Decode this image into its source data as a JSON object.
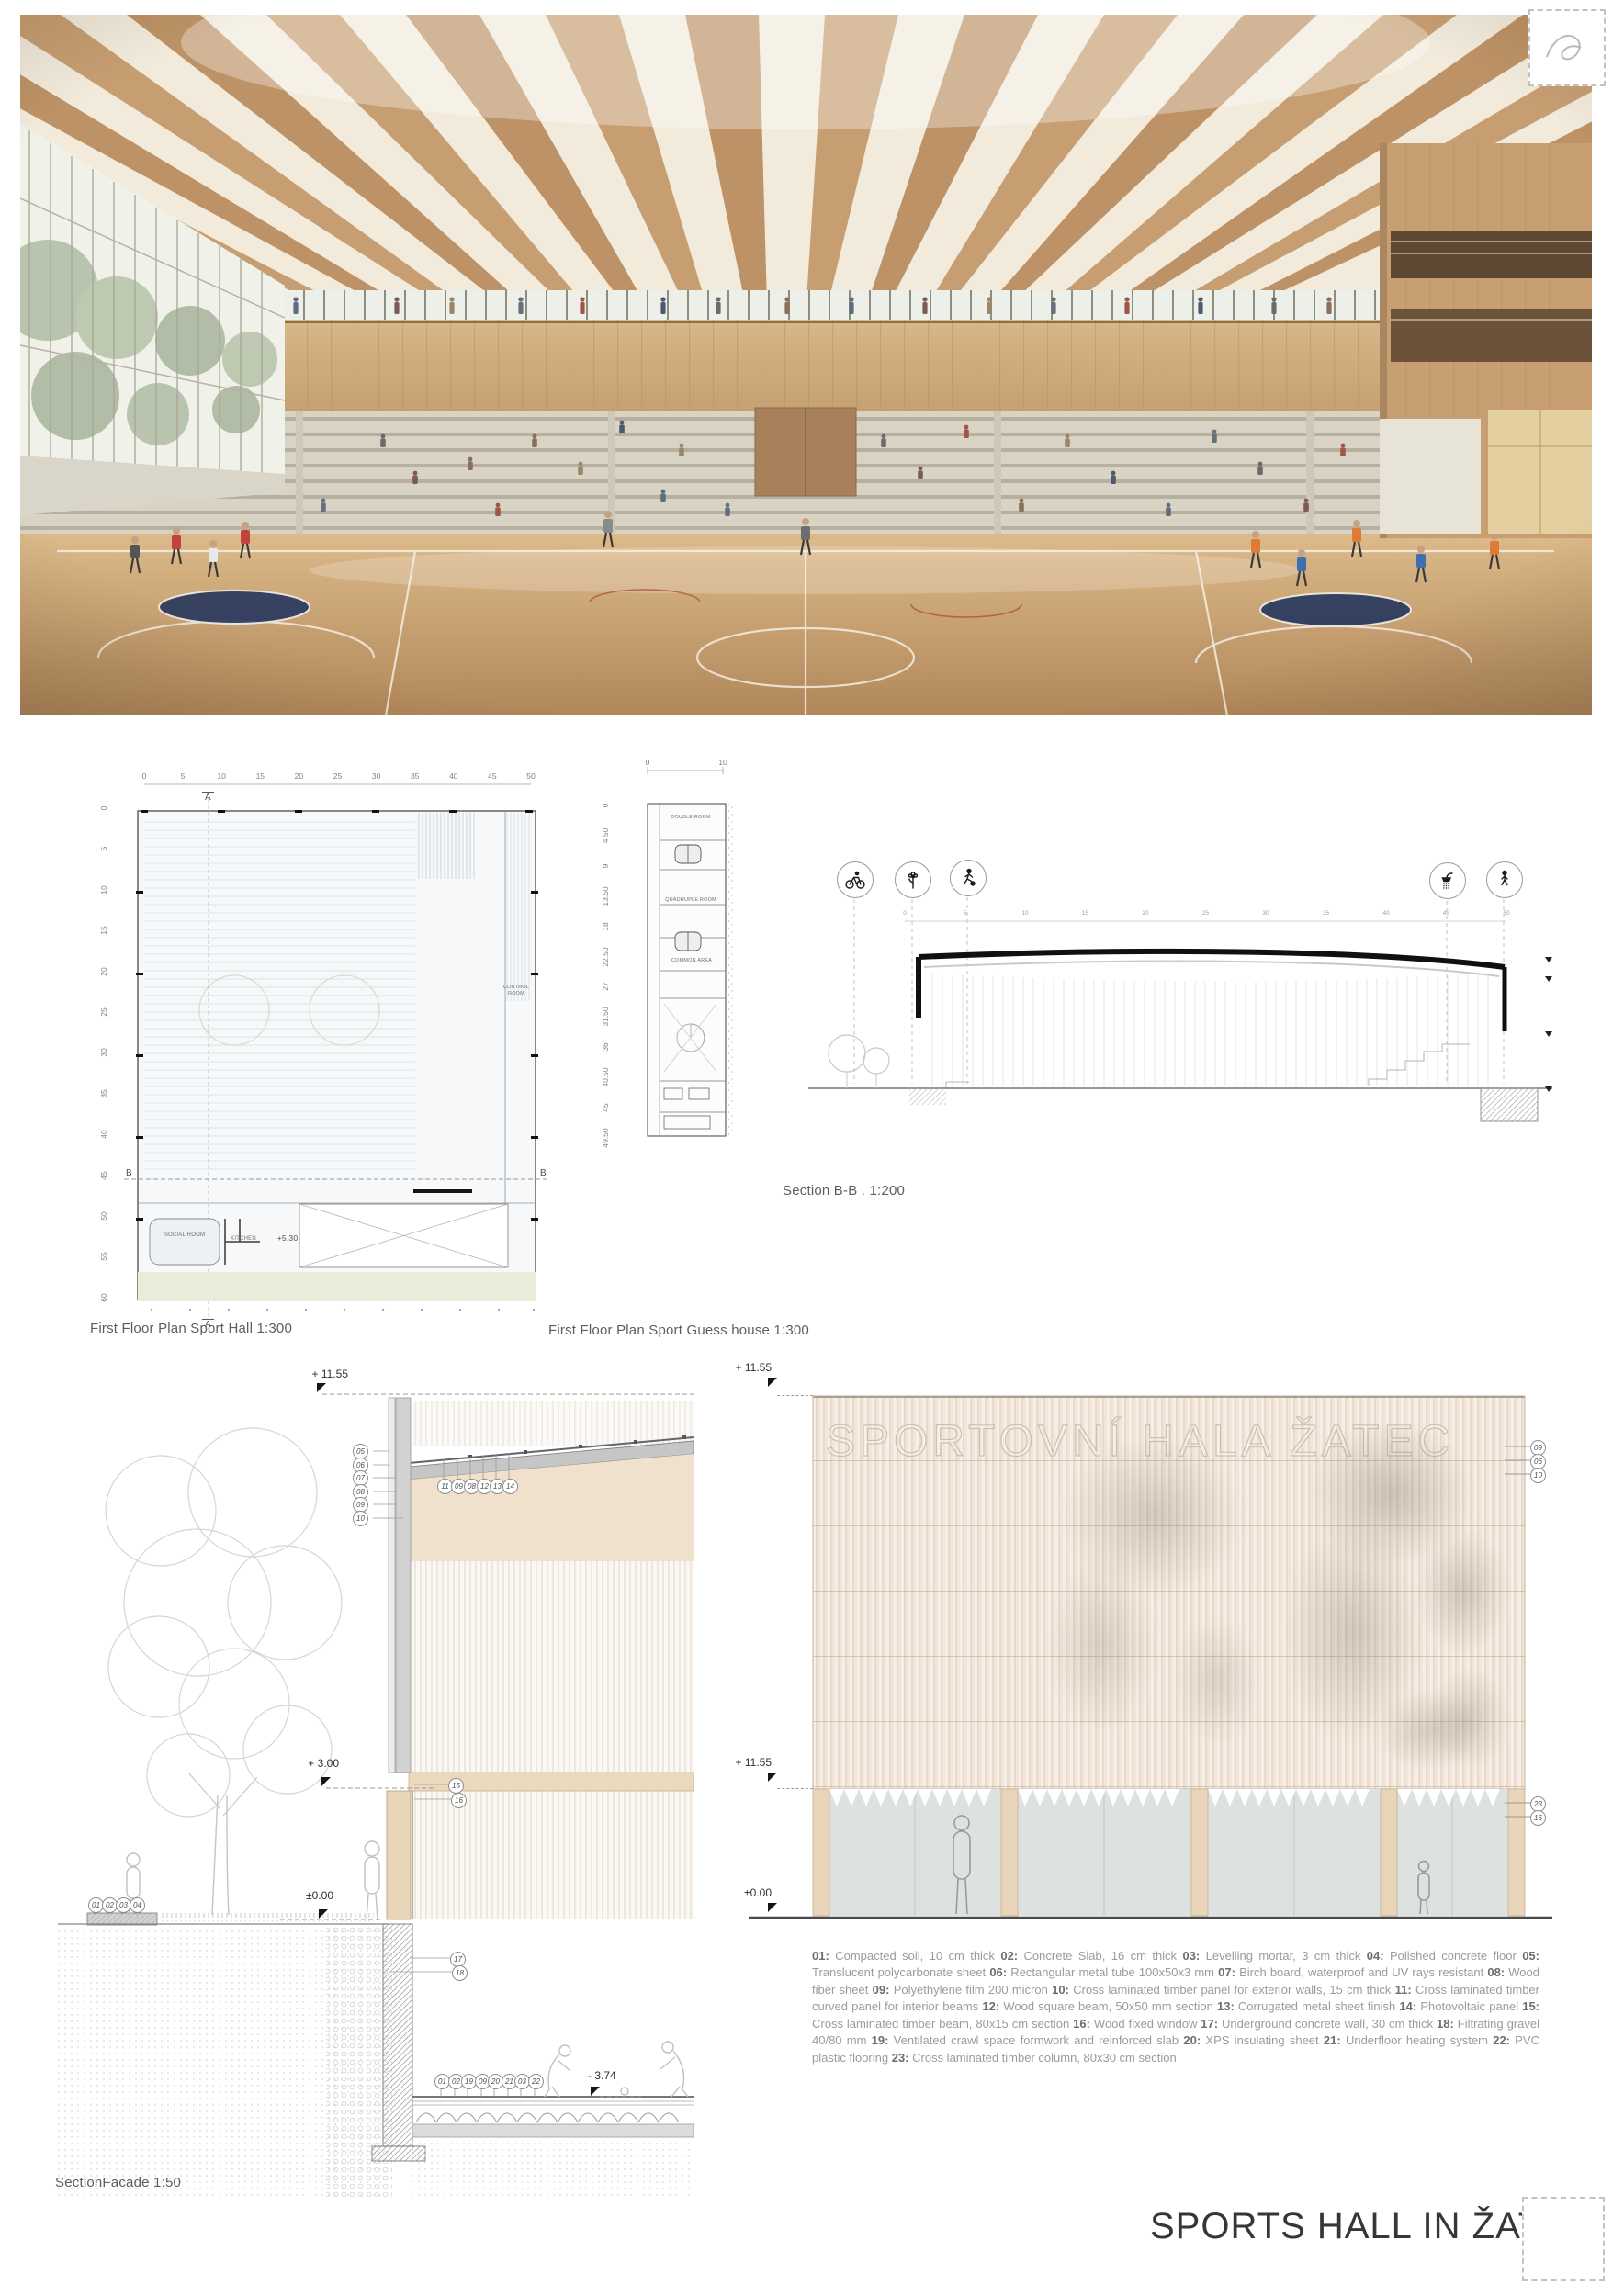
{
  "board": {
    "title": "SPORTS HALL IN ŽATEC"
  },
  "labels": {
    "plan_hall": "First Floor Plan Sport Hall 1:300",
    "plan_guest": "First Floor Plan Sport Guess house 1:300",
    "section_bb": "Section B-B . 1:200",
    "section_facade": "SectionFacade 1:50"
  },
  "plan_hall": {
    "ruler_top": [
      "0",
      "5",
      "10",
      "15",
      "20",
      "25",
      "30",
      "35",
      "40",
      "45",
      "50"
    ],
    "ruler_left": [
      "0",
      "5",
      "10",
      "15",
      "20",
      "25",
      "30",
      "35",
      "40",
      "45",
      "50",
      "55",
      "60"
    ],
    "axis": "A",
    "section_marker": "B",
    "rooms": {
      "control": "CONTROL ROOM",
      "social": "SOCIAL ROOM",
      "kitchen": "KITCHEN"
    },
    "level": "+5.30"
  },
  "plan_guest": {
    "ruler_top": [
      "0",
      "10"
    ],
    "ruler_left": [
      "0",
      "4.50",
      "9",
      "13.50",
      "18",
      "22.50",
      "27",
      "31.50",
      "36",
      "40.50",
      "45",
      "49.50"
    ],
    "rooms": [
      "DOUBLE ROOM",
      "QUADRUPLE ROOM",
      "COMMON AREA"
    ]
  },
  "section_bb": {
    "ruler": [
      "0",
      "5",
      "10",
      "15",
      "20",
      "25",
      "30",
      "35",
      "40",
      "45",
      "50"
    ],
    "icons": [
      "bicycle-icon",
      "flower-icon",
      "soccer-player-icon",
      "shower-icon",
      "pedestrian-icon"
    ]
  },
  "facade_detail": {
    "levels": {
      "top": "+ 11.55",
      "mid": "+ 3.00",
      "ground": "±0.00",
      "floor": "- 3.74"
    },
    "callouts_wall_left": [
      "05",
      "06",
      "07",
      "08",
      "09",
      "10"
    ],
    "callouts_roof": [
      "11",
      "09",
      "08",
      "12",
      "13",
      "14"
    ],
    "callouts_mid": [
      "15",
      "16"
    ],
    "callouts_pavement": [
      "01",
      "02",
      "03",
      "04"
    ],
    "callouts_underground": [
      "17",
      "18"
    ],
    "callouts_floor": [
      "01",
      "02",
      "19",
      "09",
      "20",
      "21",
      "03",
      "22"
    ]
  },
  "elevation": {
    "watermark": "SPORTOVNÍ HALA ŽATEC",
    "levels": {
      "top": "+ 11.55",
      "mid": "+ 11.55",
      "ground": "±0.00"
    },
    "callouts_top": [
      "09",
      "06",
      "10"
    ],
    "callouts_bottom": [
      "23",
      "16"
    ]
  },
  "legend": {
    "items": [
      {
        "n": "01",
        "t": "Compacted soil, 10 cm thick"
      },
      {
        "n": "02",
        "t": "Concrete Slab, 16 cm thick"
      },
      {
        "n": "03",
        "t": "Levelling mortar, 3 cm thick"
      },
      {
        "n": "04",
        "t": "Polished concrete floor"
      },
      {
        "n": "05",
        "t": "Translucent polycarbonate sheet"
      },
      {
        "n": "06",
        "t": "Rectangular metal tube 100x50x3 mm"
      },
      {
        "n": "07",
        "t": "Birch board, waterproof and UV rays resistant"
      },
      {
        "n": "08",
        "t": "Wood fiber sheet"
      },
      {
        "n": "09",
        "t": "Polyethylene film 200 micron"
      },
      {
        "n": "10",
        "t": "Cross laminated timber panel for exterior walls, 15 cm thick"
      },
      {
        "n": "11",
        "t": "Cross laminated timber curved panel for interior beams"
      },
      {
        "n": "12",
        "t": "Wood square beam, 50x50 mm section"
      },
      {
        "n": "13",
        "t": "Corrugated metal sheet finish"
      },
      {
        "n": "14",
        "t": "Photovoltaic panel"
      },
      {
        "n": "15",
        "t": "Cross laminated timber beam, 80x15 cm section"
      },
      {
        "n": "16",
        "t": "Wood fixed window"
      },
      {
        "n": "17",
        "t": "Underground concrete wall, 30 cm thick"
      },
      {
        "n": "18",
        "t": "Filtrating gravel 40/80 mm"
      },
      {
        "n": "19",
        "t": "Ventilated crawl space formwork and reinforced slab"
      },
      {
        "n": "20",
        "t": "XPS insulating sheet"
      },
      {
        "n": "21",
        "t": "Underfloor heating system"
      },
      {
        "n": "22",
        "t": "PVC plastic flooring"
      },
      {
        "n": "23",
        "t": "Cross laminated timber column, 80x30 cm section"
      }
    ]
  },
  "colors": {
    "wood": "#c79e72",
    "floor": "#c49a67",
    "plan_green": "#e9ecd8",
    "stripe": "#e9dacb"
  }
}
